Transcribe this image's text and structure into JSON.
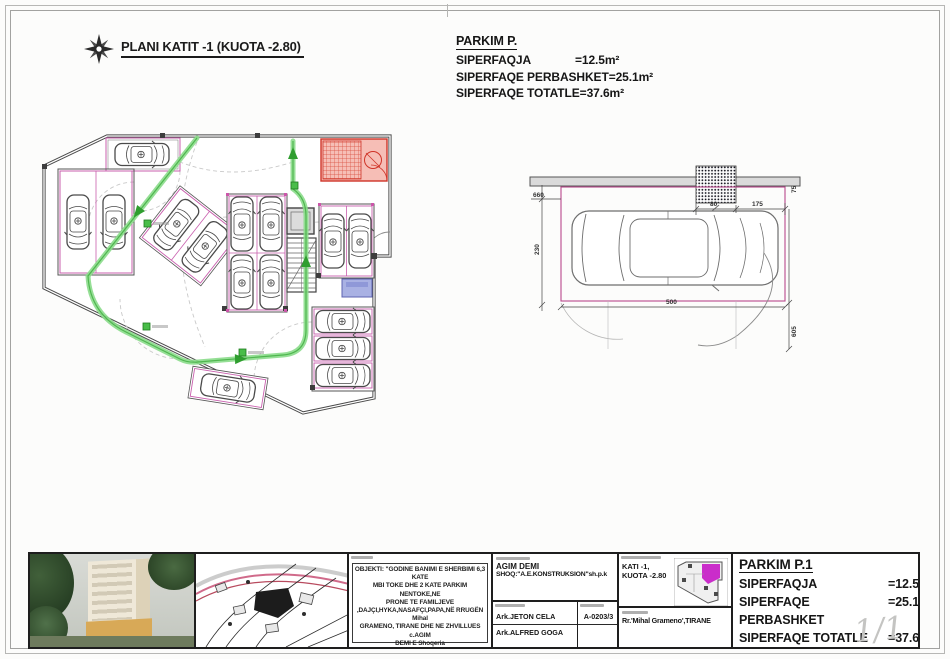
{
  "sheet": {
    "page_number": "1/1"
  },
  "plan": {
    "title": "PLANI KATIT -1 (KUOTA -2.80)"
  },
  "summary_top": {
    "heading": "PARKIM  P.",
    "rows": [
      {
        "label": "SIPERFAQJA",
        "value": "=12.5m²"
      },
      {
        "label": "SIPERFAQE PERBASHKET",
        "value": "=25.1m²"
      },
      {
        "label": "SIPERFAQE TOTATLE",
        "value": "=37.6m²"
      }
    ]
  },
  "detail_drawing": {
    "dimensions": {
      "d660": "660",
      "d230": "230",
      "d80": "80",
      "d175": "175",
      "d75": "75",
      "d500": "500",
      "d605": "605"
    }
  },
  "title_block": {
    "objekti_lines": [
      "OBJEKTI: \"GODINE  BANIMI E SHERBIMI 6,3 KATE",
      "MBI TOKE DHE 2 KATE PARKIM NENTOKE,NE",
      "PRONE TE FAMILJEVE",
      ",DAJÇI,HYKA,NASAFÇI,PAPA,NË RRUGËN Mihal",
      "GRAMENO, TIRANE DHE NE ZHVILLUES c.AGIM",
      "DEMI E Shoqeria \"A.E.KONSTRUKSION\"sh.p.k,",
      "DHE NE SUBJEKT NDERTUES    Shoqeria",
      "\"A.E.KONSTRUKSION\" sh.p.k\""
    ],
    "investor_name": "AGIM DEMI",
    "investor_company": "SHOQ:\"A.E.KONSTRUKSION\"sh.p.k",
    "architect_1": "Ark.JETON CELA",
    "architect_2": "Ark.ALFRED GOGA",
    "license_no": "A-0203/3",
    "level_line1": "KATI -1,",
    "level_line2": "KUOTA -2.80",
    "address": "Rr.'Mihal Grameno',TIRANE",
    "summary": {
      "heading": "PARKIM P.1",
      "rows": [
        {
          "label": "SIPERFAQJA",
          "value": "=12.5m²"
        },
        {
          "label": "SIPERFAQE PERBASHKET",
          "value": "=25.1m²"
        },
        {
          "label": "SIPERFAQE TOTATLE",
          "value": "=37.6m²"
        }
      ]
    }
  },
  "colors": {
    "route_green": "#8bdb8b",
    "bay_pink": "#c95fae",
    "ramp_red": "#cf3428",
    "room_blue": "#a9b1e3",
    "minimap_magenta": "#c517c5"
  }
}
